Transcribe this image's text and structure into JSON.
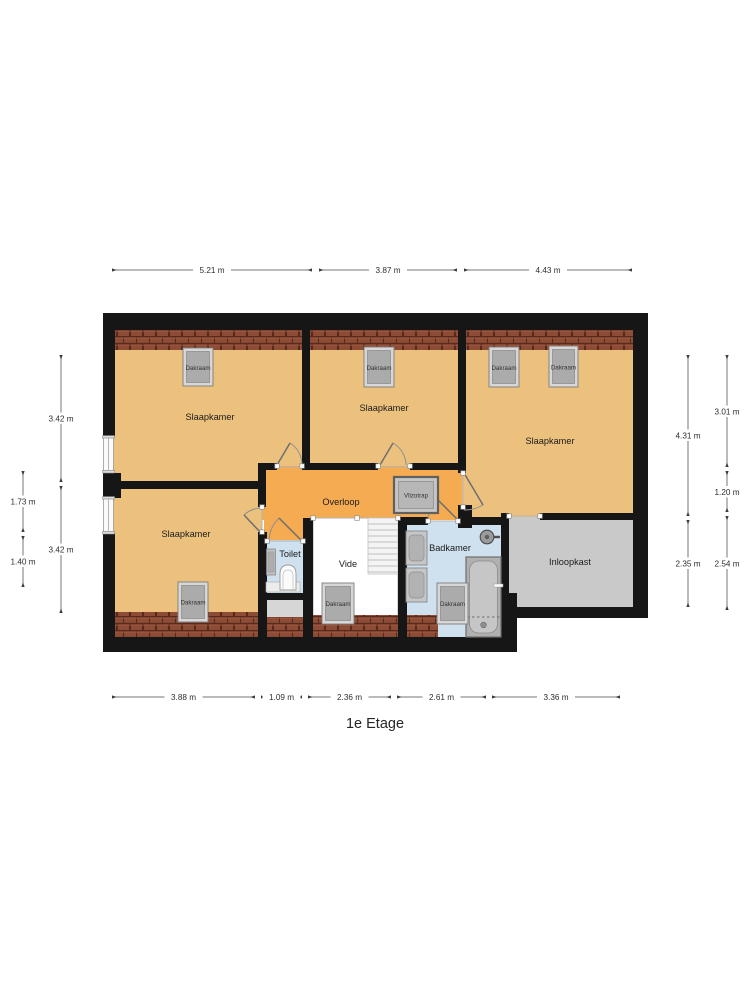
{
  "title": "1e Etage",
  "rooms": [
    {
      "id": "bedroom-top-left",
      "label": "Slaapkamer"
    },
    {
      "id": "bedroom-top-middle",
      "label": "Slaapkamer"
    },
    {
      "id": "bedroom-top-right",
      "label": "Slaapkamer"
    },
    {
      "id": "bedroom-bottom-left",
      "label": "Slaapkamer"
    },
    {
      "id": "landing",
      "label": "Overloop"
    },
    {
      "id": "toilet",
      "label": "Toilet"
    },
    {
      "id": "void",
      "label": "Vide"
    },
    {
      "id": "bathroom",
      "label": "Badkamer"
    },
    {
      "id": "walk-in-closet",
      "label": "Inloopkast"
    }
  ],
  "fixtures": {
    "roof_window_label": "Dakraam",
    "loft_ladder_label": "Vlizotrap"
  },
  "dimensions": {
    "top": [
      "5.21 m",
      "3.87 m",
      "4.43 m"
    ],
    "bottom": [
      "3.88 m",
      "1.09 m",
      "2.36 m",
      "2.61 m",
      "3.36 m"
    ],
    "left_inner": [
      "3.42 m",
      "3.42 m"
    ],
    "left_outer": [
      "1.73 m",
      "1.40 m"
    ],
    "right_inner": [
      "4.31 m",
      "2.35 m"
    ],
    "right_outer": [
      "3.01 m",
      "1.20 m",
      "2.54 m"
    ]
  },
  "colors": {
    "wall": "#161616",
    "bedroom_floor": "#ecc17e",
    "landing_floor": "#f5ab51",
    "wet_floor": "#cfe0ee",
    "closet_floor": "#c9c9c9",
    "ledge_floor": "#d6d6d6",
    "roof_tile": "#8d4c35",
    "dimension_text": "#2e2e2e"
  }
}
